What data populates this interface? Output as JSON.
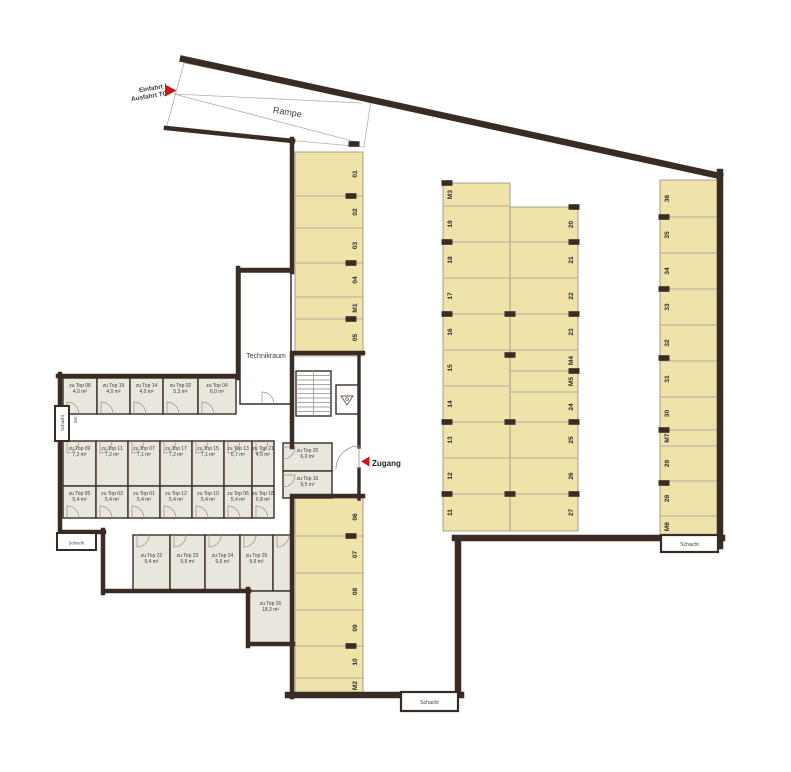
{
  "labels": {
    "ramp": "Rampe",
    "entry_line1": "Einfahrt /",
    "entry_line2": "Ausfahrt TG",
    "zugang": "Zugang",
    "technikraum": "Technikraum",
    "schacht": "Schacht",
    "ent": "Ent."
  },
  "colors": {
    "wall": "#3a2c25",
    "parking_fill": "#f0e3aa",
    "parking_edge": "#8f897a",
    "room_fill": "#e9e6de",
    "divider": "#b3ac98",
    "door": "#97917f",
    "text": "#3c3c3c",
    "accent_red": "#cc1517"
  },
  "parking": {
    "columns": [
      {
        "id": "west-upper",
        "x0": 295,
        "x1": 363,
        "label_x": 355,
        "spaces": [
          {
            "label": "01",
            "y0": 152,
            "y1": 196
          },
          {
            "label": "02",
            "y0": 196,
            "y1": 228
          },
          {
            "label": "03",
            "y0": 228,
            "y1": 263
          },
          {
            "label": "04",
            "y0": 263,
            "y1": 297
          },
          {
            "label": "M1",
            "y0": 297,
            "y1": 319
          },
          {
            "label": "05",
            "y0": 319,
            "y1": 356
          }
        ]
      },
      {
        "id": "west-lower",
        "x0": 295,
        "x1": 363,
        "label_x": 355,
        "spaces": [
          {
            "label": "06",
            "y0": 498,
            "y1": 536
          },
          {
            "label": "07",
            "y0": 536,
            "y1": 573
          },
          {
            "label": "08",
            "y0": 573,
            "y1": 610
          },
          {
            "label": "09",
            "y0": 610,
            "y1": 646
          },
          {
            "label": "10",
            "y0": 646,
            "y1": 678
          },
          {
            "label": "M2",
            "y0": 678,
            "y1": 693
          }
        ]
      },
      {
        "id": "mid-west",
        "x0": 443,
        "x1": 510,
        "label_x": 450,
        "spaces": [
          {
            "label": "M3",
            "y0": 183,
            "y1": 206
          },
          {
            "label": "19",
            "y0": 206,
            "y1": 242
          },
          {
            "label": "18",
            "y0": 242,
            "y1": 278
          },
          {
            "label": "17",
            "y0": 278,
            "y1": 314
          },
          {
            "label": "16",
            "y0": 314,
            "y1": 350
          },
          {
            "label": "15",
            "y0": 350,
            "y1": 386
          },
          {
            "label": "14",
            "y0": 386,
            "y1": 422
          },
          {
            "label": "13",
            "y0": 422,
            "y1": 458
          },
          {
            "label": "12",
            "y0": 458,
            "y1": 494
          },
          {
            "label": "11",
            "y0": 494,
            "y1": 531
          }
        ]
      },
      {
        "id": "mid-east",
        "x0": 510,
        "x1": 578,
        "label_x": 571,
        "spaces": [
          {
            "label": "20",
            "y0": 207,
            "y1": 242
          },
          {
            "label": "21",
            "y0": 242,
            "y1": 278
          },
          {
            "label": "22",
            "y0": 278,
            "y1": 314
          },
          {
            "label": "23",
            "y0": 314,
            "y1": 350
          },
          {
            "label": "M4",
            "y0": 350,
            "y1": 371
          },
          {
            "label": "M5",
            "y0": 371,
            "y1": 392
          },
          {
            "label": "24",
            "y0": 392,
            "y1": 422
          },
          {
            "label": "25",
            "y0": 422,
            "y1": 458
          },
          {
            "label": "26",
            "y0": 458,
            "y1": 494
          },
          {
            "label": "27",
            "y0": 494,
            "y1": 531
          }
        ]
      },
      {
        "id": "east",
        "x0": 660,
        "x1": 722,
        "label_x": 667,
        "spaces": [
          {
            "label": "36",
            "y0": 180,
            "y1": 217
          },
          {
            "label": "35",
            "y0": 217,
            "y1": 253
          },
          {
            "label": "34",
            "y0": 253,
            "y1": 289
          },
          {
            "label": "33",
            "y0": 289,
            "y1": 325
          },
          {
            "label": "32",
            "y0": 325,
            "y1": 361
          },
          {
            "label": "31",
            "y0": 361,
            "y1": 397
          },
          {
            "label": "30",
            "y0": 397,
            "y1": 430
          },
          {
            "label": "M7",
            "y0": 430,
            "y1": 446
          },
          {
            "label": "29",
            "y0": 446,
            "y1": 481
          },
          {
            "label": "28",
            "y0": 481,
            "y1": 516
          },
          {
            "label": "M6",
            "y0": 516,
            "y1": 537
          }
        ]
      }
    ],
    "pillars": [
      {
        "x": 351,
        "y": 196
      },
      {
        "x": 351,
        "y": 263
      },
      {
        "x": 351,
        "y": 319
      },
      {
        "x": 351,
        "y": 536
      },
      {
        "x": 351,
        "y": 646
      },
      {
        "x": 447,
        "y": 183
      },
      {
        "x": 447,
        "y": 242
      },
      {
        "x": 447,
        "y": 314
      },
      {
        "x": 447,
        "y": 422
      },
      {
        "x": 447,
        "y": 494
      },
      {
        "x": 510,
        "y": 314
      },
      {
        "x": 510,
        "y": 355
      },
      {
        "x": 510,
        "y": 422
      },
      {
        "x": 510,
        "y": 494
      },
      {
        "x": 574,
        "y": 207
      },
      {
        "x": 574,
        "y": 242
      },
      {
        "x": 574,
        "y": 314
      },
      {
        "x": 574,
        "y": 371
      },
      {
        "x": 574,
        "y": 422
      },
      {
        "x": 574,
        "y": 494
      },
      {
        "x": 664,
        "y": 217
      },
      {
        "x": 664,
        "y": 289
      },
      {
        "x": 664,
        "y": 358
      },
      {
        "x": 664,
        "y": 430
      },
      {
        "x": 664,
        "y": 483
      },
      {
        "x": 354,
        "y": 144
      }
    ]
  },
  "storage": {
    "rooms": [
      {
        "label": "zu Top 08",
        "area": "4,0 m²",
        "x0": 63,
        "y0": 378,
        "x1": 97,
        "y1": 414,
        "door": "bottom"
      },
      {
        "label": "zu Top 19",
        "area": "4,0 m²",
        "x0": 97,
        "y0": 378,
        "x1": 130,
        "y1": 414,
        "door": "bottom"
      },
      {
        "label": "zu Top 14",
        "area": "4,0 m²",
        "x0": 130,
        "y0": 378,
        "x1": 163,
        "y1": 414,
        "door": "bottom"
      },
      {
        "label": "zu Top 02",
        "area": "5,3 m²",
        "x0": 163,
        "y0": 378,
        "x1": 198,
        "y1": 414,
        "door": "bottom"
      },
      {
        "label": "zu Top 04",
        "area": "6,0 m²",
        "x0": 198,
        "y0": 378,
        "x1": 236,
        "y1": 414,
        "door": "bottom"
      },
      {
        "label": "zu Top 09",
        "area": "7,2 m²",
        "x0": 63,
        "y0": 441,
        "x1": 96,
        "y1": 486,
        "door": "top"
      },
      {
        "label": "zu Top 11",
        "area": "7,2 m²",
        "x0": 96,
        "y0": 441,
        "x1": 128,
        "y1": 486,
        "door": "top"
      },
      {
        "label": "zu Top 07",
        "area": "7,1 m²",
        "x0": 128,
        "y0": 441,
        "x1": 160,
        "y1": 486,
        "door": "top"
      },
      {
        "label": "zu Top 17",
        "area": "7,2 m²",
        "x0": 160,
        "y0": 441,
        "x1": 192,
        "y1": 486,
        "door": "top"
      },
      {
        "label": "zu Top 15",
        "area": "7,1 m²",
        "x0": 192,
        "y0": 441,
        "x1": 224,
        "y1": 486,
        "door": "top"
      },
      {
        "label": "zu Top 13",
        "area": "6,7 m²",
        "x0": 224,
        "y0": 441,
        "x1": 252,
        "y1": 486,
        "door": "top"
      },
      {
        "label": "zu Top 21",
        "area": "4,9 m²",
        "x0": 252,
        "y0": 441,
        "x1": 274,
        "y1": 486,
        "door": "top"
      },
      {
        "label": "zu Top 05",
        "area": "5,4 m²",
        "x0": 63,
        "y0": 486,
        "x1": 96,
        "y1": 518,
        "door": "bottom"
      },
      {
        "label": "zu Top 03",
        "area": "5,4 m²",
        "x0": 96,
        "y0": 486,
        "x1": 128,
        "y1": 518,
        "door": "bottom"
      },
      {
        "label": "zu Top 01",
        "area": "5,4 m²",
        "x0": 128,
        "y0": 486,
        "x1": 160,
        "y1": 518,
        "door": "bottom"
      },
      {
        "label": "zu Top 12",
        "area": "5,4 m²",
        "x0": 160,
        "y0": 486,
        "x1": 192,
        "y1": 518,
        "door": "bottom"
      },
      {
        "label": "zu Top 10",
        "area": "5,4 m²",
        "x0": 192,
        "y0": 486,
        "x1": 224,
        "y1": 518,
        "door": "bottom"
      },
      {
        "label": "zu Top 06",
        "area": "5,4 m²",
        "x0": 224,
        "y0": 486,
        "x1": 252,
        "y1": 518,
        "door": "bottom"
      },
      {
        "label": "zu Top 18",
        "area": "6,8 m²",
        "x0": 252,
        "y0": 486,
        "x1": 274,
        "y1": 518,
        "door": "bottom"
      },
      {
        "label": "zu Top 22",
        "area": "9,4 m²",
        "x0": 133,
        "y0": 535,
        "x1": 170,
        "y1": 591,
        "door": "top",
        "ly": 557
      },
      {
        "label": "zu Top 23",
        "area": "9,6 m²",
        "x0": 170,
        "y0": 535,
        "x1": 205,
        "y1": 591,
        "door": "top",
        "ly": 557
      },
      {
        "label": "zu Top 24",
        "area": "9,6 m²",
        "x0": 205,
        "y0": 535,
        "x1": 240,
        "y1": 591,
        "door": "top",
        "ly": 557
      },
      {
        "label": "zu Top 25",
        "area": "9,6 m²",
        "x0": 240,
        "y0": 535,
        "x1": 273,
        "y1": 591,
        "door": "top",
        "ly": 557
      },
      {
        "label": "",
        "area": "",
        "x0": 273,
        "y0": 535,
        "x1": 292,
        "y1": 591,
        "door": "top"
      },
      {
        "label": "zu Top 26",
        "area": "18,3 m²",
        "x0": 249,
        "y0": 591,
        "x1": 292,
        "y1": 643,
        "door": "none",
        "ly": 605
      },
      {
        "label": "zu Top 20",
        "area": "6,0 m²",
        "x0": 283,
        "y0": 443,
        "x1": 332,
        "y1": 471,
        "door": "left",
        "ly": 452
      },
      {
        "label": "zu Top 16",
        "area": "9,5 m²",
        "x0": 283,
        "y0": 471,
        "x1": 332,
        "y1": 498,
        "door": "left",
        "ly": 480
      }
    ]
  }
}
